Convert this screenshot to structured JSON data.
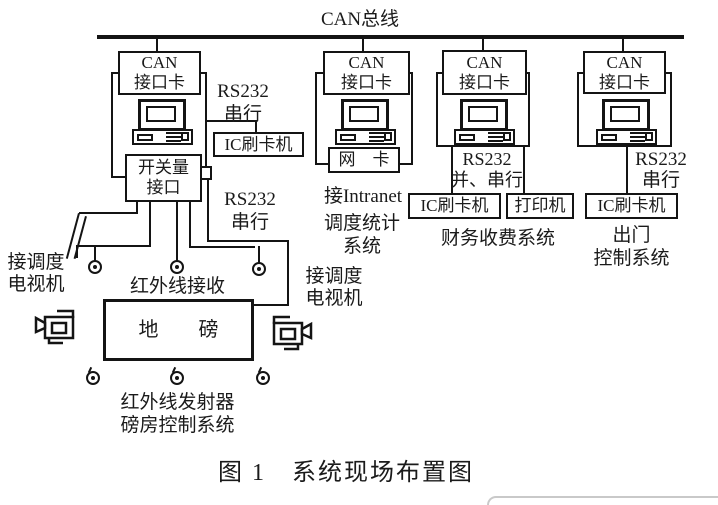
{
  "bus": {
    "label": "CAN总线"
  },
  "stations": {
    "weighbridge": {
      "can_card": "CAN\n接口卡",
      "rs232_serial_top": "RS232\n串行",
      "ic_reader": "IC刷卡机",
      "switch_interface": "开关量\n接口",
      "rs232_serial_bottom": "RS232\n串行"
    },
    "dispatch": {
      "can_card": "CAN\n接口卡",
      "network_card": "网　卡",
      "intranet": "接Intranet",
      "system_name": "调度统计\n系统"
    },
    "finance": {
      "can_card": "CAN\n接口卡",
      "rs232": "RS232\n并、串行",
      "ic_reader": "IC刷卡机",
      "printer": "打印机",
      "system_name": "财务收费系统"
    },
    "gate": {
      "can_card": "CAN\n接口卡",
      "rs232": "RS232\n串行",
      "ic_reader": "IC刷卡机",
      "system_name": "出门\n控制系统"
    }
  },
  "site": {
    "tv_left": "接调度\n电视机",
    "tv_right": "接调度\n电视机",
    "ir_receiver": "红外线接收",
    "weighbridge_label": "地　　磅",
    "ir_transmitter": "红外线发射器",
    "weigh_room_system": "磅房控制系统"
  },
  "caption": "图 1　系统现场布置图",
  "colors": {
    "ink": "#1a1a1a",
    "background": "#ffffff",
    "overlay_border": "#c9c9c9"
  }
}
